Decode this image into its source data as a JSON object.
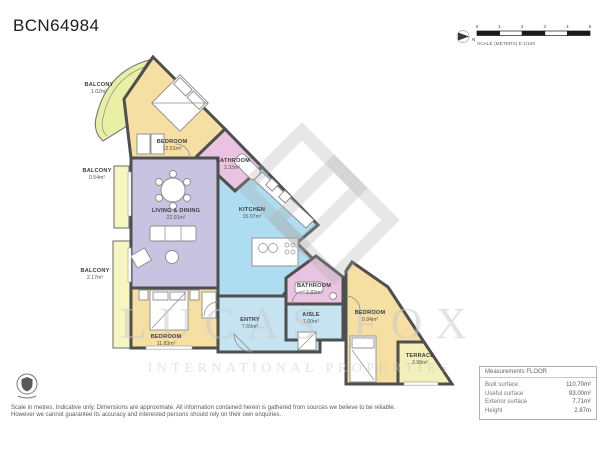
{
  "title": "BCN64984",
  "scale_bar": {
    "ticks": [
      "0",
      "1",
      "2",
      "3",
      "4",
      "5"
    ],
    "label": "SCALE (METERS) E:1/100",
    "north_label": "N"
  },
  "rooms": {
    "balcony_top": {
      "name": "BALCONY",
      "area": "1.02m²"
    },
    "bedroom_top": {
      "name": "BEDROOM",
      "area": "12.51m²"
    },
    "bathroom_top": {
      "name": "BATHROOM",
      "area": "3.33m²"
    },
    "balcony_mid": {
      "name": "BALCONY",
      "area": "0.54m²"
    },
    "living": {
      "name": "LIVING & DINING",
      "area": "22.91m²"
    },
    "kitchen": {
      "name": "KITCHEN",
      "area": "15.07m²"
    },
    "balcony_low": {
      "name": "BALCONY",
      "area": "2.17m²"
    },
    "bedroom_left": {
      "name": "BEDROOM",
      "area": "11.83m²"
    },
    "entry": {
      "name": "ENTRY",
      "area": "7.69m²"
    },
    "aisle": {
      "name": "AISLE",
      "area": "7.00m²"
    },
    "bathroom_low": {
      "name": "BATHROOM",
      "area": "2.82m²"
    },
    "bedroom_right": {
      "name": "BEDROOM",
      "area": "9.84m²"
    },
    "terrace": {
      "name": "TERRACE",
      "area": "3.98m²"
    }
  },
  "watermark": {
    "line1": "LUCAS FOX",
    "line2": "INTERNATIONAL PROPERTIES"
  },
  "measurements": {
    "header": "Measurements FLOOR",
    "rows": [
      {
        "label": "Built surface",
        "value": "110.70m²"
      },
      {
        "label": "Useful surface",
        "value": "93.00m²"
      },
      {
        "label": "Exterior surface",
        "value": "7.71m²"
      },
      {
        "label": "Height",
        "value": "2.87m"
      }
    ]
  },
  "footer": {
    "disclaimer_line1": "Scale in metres. Indicative only. Dimensions are approximate. All information contained herein is gathered from sources we believe to be reliable.",
    "disclaimer_line2": "However we cannot guarantee its accuracy and interested persons should rely on their own enquiries."
  },
  "colors": {
    "bedroom": "#f5dfa2",
    "bathroom": "#e9c3e0",
    "living": "#c7c3e1",
    "kitchen": "#aedcf0",
    "hall": "#c6e3f2",
    "balcony": "#f6f6c0",
    "balcony_curved": "#e9efa4",
    "terrace": "#f3f0ba",
    "wall": "#4f4f4f"
  }
}
